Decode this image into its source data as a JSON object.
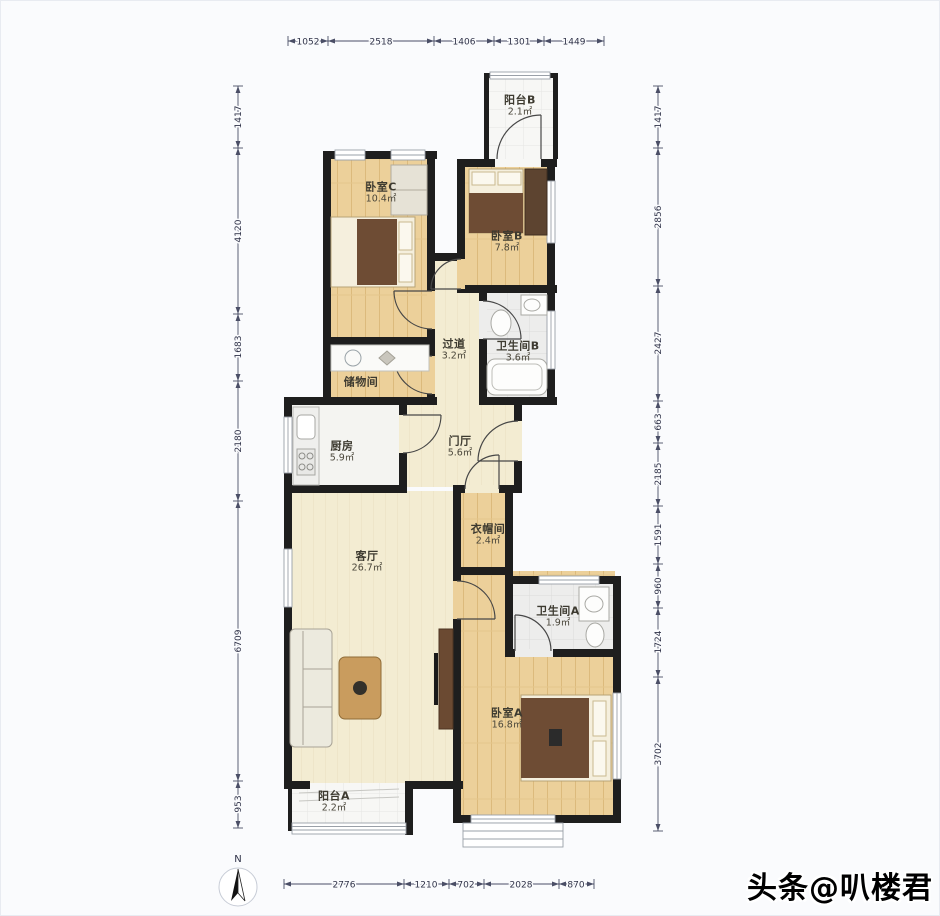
{
  "watermark": {
    "text": "头条@叭楼君"
  },
  "compass": {
    "north_label": "N"
  },
  "rooms": {
    "balcony_b": {
      "name": "阳台B",
      "area": "2.1㎡"
    },
    "bedroom_c": {
      "name": "卧室C",
      "area": "10.4㎡"
    },
    "bedroom_b": {
      "name": "卧室B",
      "area": "7.8㎡"
    },
    "corridor": {
      "name": "过道",
      "area": "3.2㎡"
    },
    "bathroom_b": {
      "name": "卫生间B",
      "area": "3.6㎡"
    },
    "storage": {
      "name": "储物间",
      "area": ""
    },
    "kitchen": {
      "name": "厨房",
      "area": "5.9㎡"
    },
    "foyer": {
      "name": "门厅",
      "area": "5.6㎡"
    },
    "cloakroom": {
      "name": "衣帽间",
      "area": "2.4㎡"
    },
    "living": {
      "name": "客厅",
      "area": "26.7㎡"
    },
    "bathroom_a": {
      "name": "卫生间A",
      "area": "1.9㎡"
    },
    "bedroom_a": {
      "name": "卧室A",
      "area": "16.8㎡"
    },
    "balcony_a": {
      "name": "阳台A",
      "area": "2.2㎡"
    }
  },
  "dimensions": {
    "top": [
      "1052",
      "2518",
      "1406",
      "1301",
      "1449"
    ],
    "bottom": [
      "2776",
      "1210",
      "702",
      "2028",
      "870"
    ],
    "left": [
      "1417",
      "4120",
      "1683",
      "2180",
      "6709",
      "953"
    ],
    "right": [
      "1417",
      "2856",
      "2427",
      "663",
      "2185",
      "1591",
      "960",
      "1724",
      "3702"
    ]
  },
  "colors": {
    "wall": "#1e1e1e",
    "wood_floor": "#ecd09a",
    "cream_floor": "#f3ecd2",
    "tile_floor": "#ededec",
    "dimension_line": "#4a4e66",
    "watermark_text": "#000000"
  }
}
